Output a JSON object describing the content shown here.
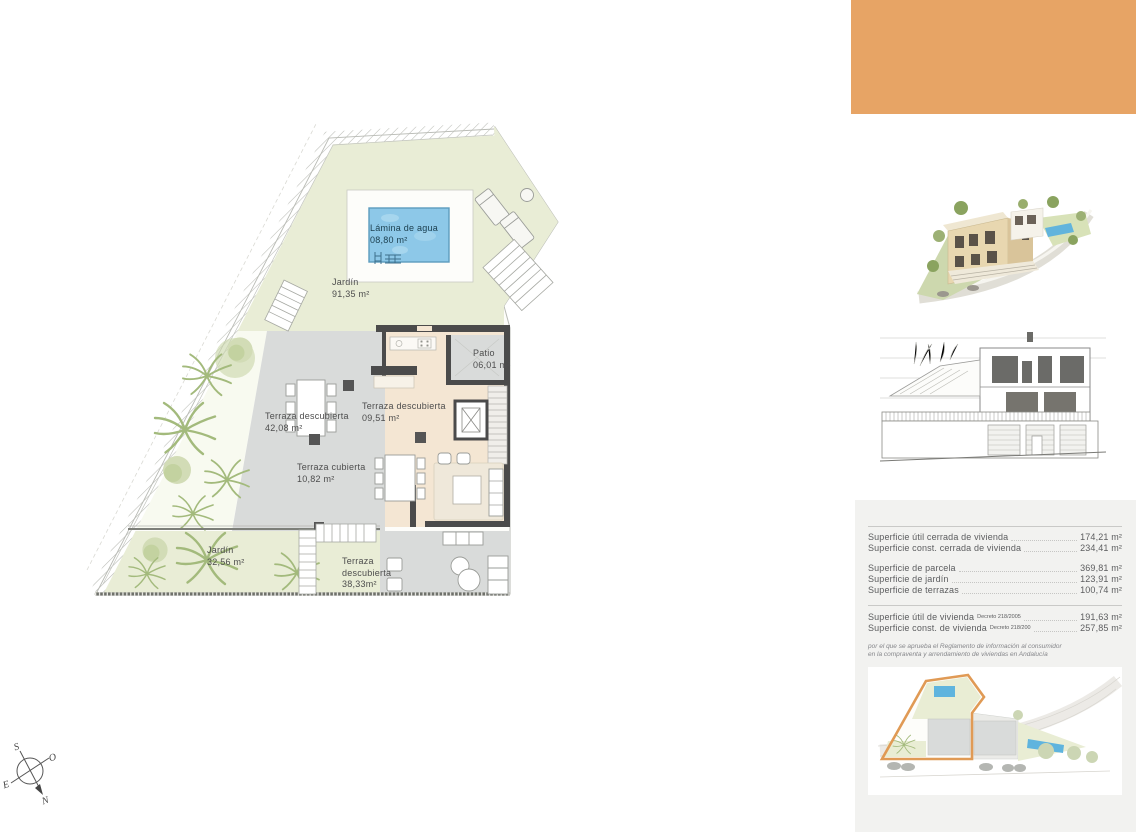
{
  "plan": {
    "pool_label": {
      "line1": "Lámina de agua",
      "line2": "08,80 m²"
    },
    "garden_top": {
      "line1": "Jardín",
      "line2": "91,35 m²"
    },
    "patio": {
      "line1": "Patio",
      "line2": "06,01 m²"
    },
    "terraza_descubierta_42": {
      "line1": "Terraza  descubierta",
      "line2": "42,08 m²"
    },
    "terraza_descubierta_09": {
      "line1": "Terraza descubierta",
      "line2": "09,51 m²"
    },
    "terraza_cubierta": {
      "line1": "Terraza cubierta",
      "line2": "10,82 m²"
    },
    "garden_bottom": {
      "line1": "Jardín",
      "line2": "32,56 m²"
    },
    "terraza_descubierta_38": {
      "line1": "Terraza",
      "line2": "descubierta",
      "line3": "38,33m²"
    }
  },
  "compass": {
    "n": "N",
    "s": "S",
    "e": "E",
    "o": "O"
  },
  "summary": {
    "group1": [
      {
        "label": "Superficie útil cerrada de vivienda",
        "value": "174,21 m²"
      },
      {
        "label": "Superficie const. cerrada de vivienda",
        "value": "234,41 m²"
      }
    ],
    "group2": [
      {
        "label": "Superficie de parcela",
        "value": "369,81  m²"
      },
      {
        "label": "Superficie de jardín",
        "value": "123,91  m²"
      },
      {
        "label": "Superficie de terrazas",
        "value": "100,74  m²"
      }
    ],
    "group3": [
      {
        "label": "Superficie útil de vivienda",
        "decree": "Decreto 218/2005",
        "value": "191,63 m²"
      },
      {
        "label": "Superficie const. de vivienda",
        "decree": "Decreto 218/200",
        "value": "257,85 m²"
      }
    ],
    "note": "por el que se aprueba el Reglamento de información al consumidor en la compraventa y arrendamiento de viviendas en Andalucía"
  },
  "colors": {
    "accent_orange": "#e7a465",
    "panel_gray": "#f2f2f0",
    "garden_green": "#e9edd6",
    "terrace_gray": "#d9dbda",
    "interior_beige": "#f4e6d3",
    "pool_blue": "#8dc8e8",
    "wall_dark": "#4b4b4b",
    "site_outline_orange": "#e09a55"
  }
}
